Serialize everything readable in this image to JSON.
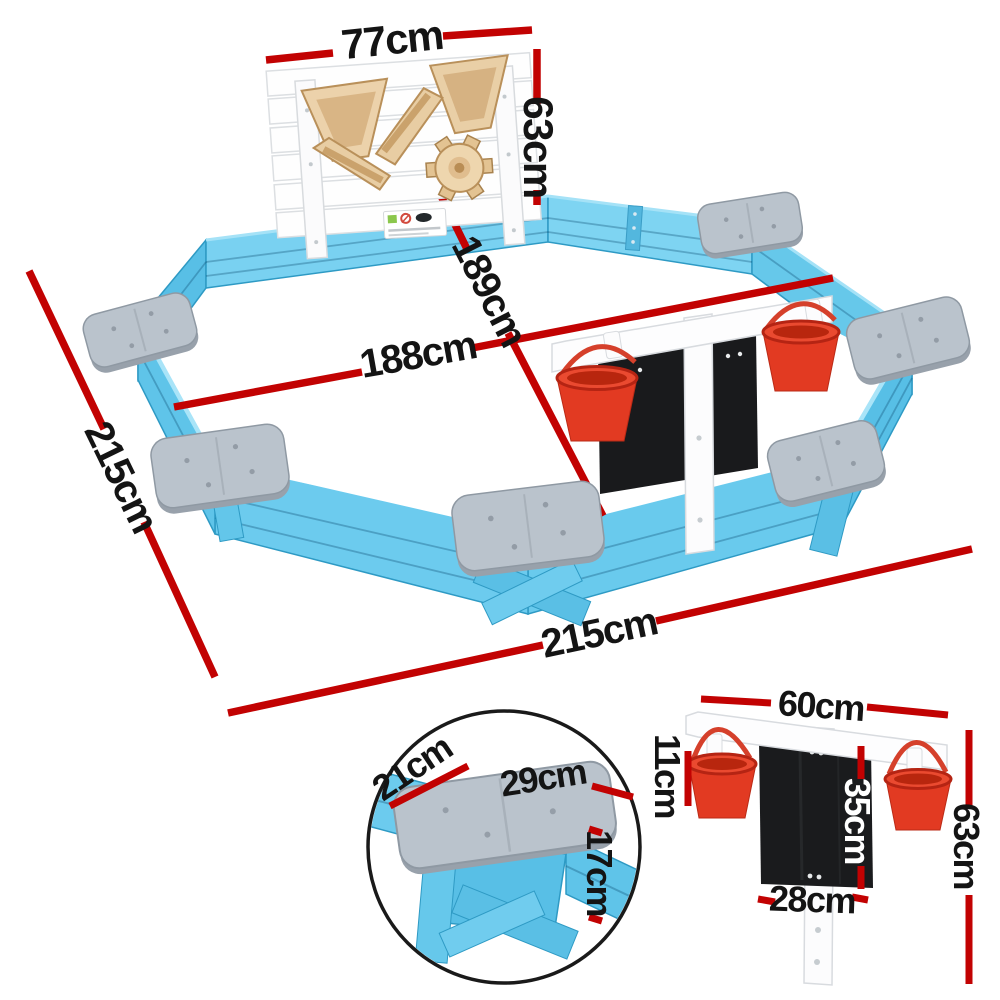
{
  "page": {
    "title": "Octagonal kids sandpit dimension diagram",
    "background": "#ffffff",
    "units": "cm"
  },
  "colors": {
    "dimension_red": "#c20202",
    "label_black": "#141414",
    "wall_blue": "#69caed",
    "wall_blue_dark": "#2e9ac4",
    "seat_grey": "#bac3cc",
    "panel_white": "#fdfdfe",
    "toy_wood": "#e9cfa6",
    "bucket_red": "#e23a22",
    "chalkboard_black": "#1a1b1d"
  },
  "main_diagram": {
    "description": "Blue octagonal wooden sandpit with white play panel, six grey corner seats, hanging red buckets and chalkboard rail",
    "labels": {
      "panel_width": "77cm",
      "panel_height": "63cm",
      "diagonal": "189cm",
      "inner_width": "188cm",
      "side_length": "215cm",
      "overall_width": "215cm"
    }
  },
  "seat_inset": {
    "description": "Corner seat close-up in circle",
    "labels": {
      "seat_depth": "21cm",
      "seat_width": "29cm",
      "wall_height": "17cm"
    }
  },
  "accessory_detail": {
    "description": "Bucket and chalkboard rail detail",
    "labels": {
      "rail_width": "60cm",
      "bucket_height": "11cm",
      "board_height": "35cm",
      "overall_height": "63cm",
      "board_width": "28cm"
    }
  }
}
